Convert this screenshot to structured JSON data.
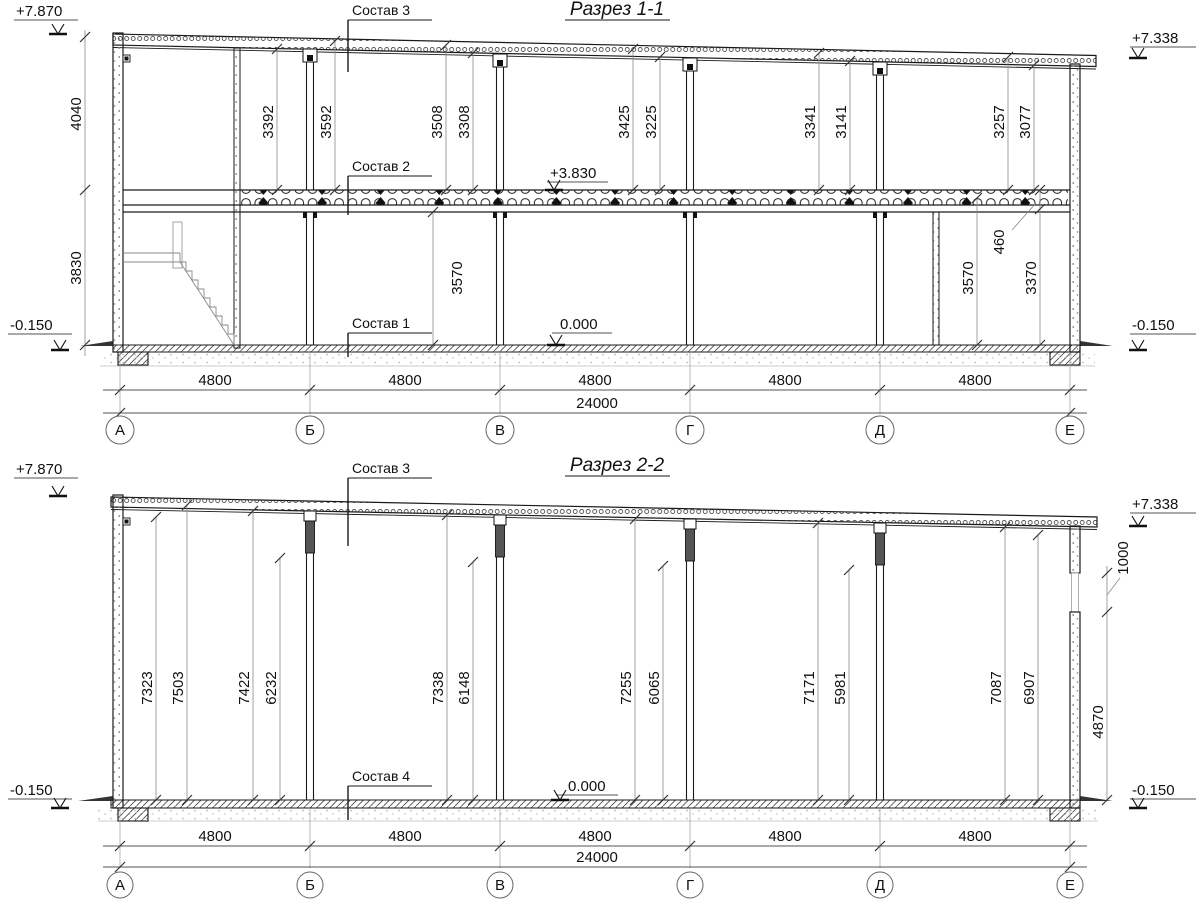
{
  "s1": {
    "title": "Разрез 1-1",
    "callouts": {
      "sostav3": "Состав 3",
      "sostav2": "Состав 2",
      "sostav1": "Состав 1"
    },
    "elevations": {
      "top_left": "+7.870",
      "top_right": "+7.338",
      "floor2": "+3.830",
      "zero": "0.000",
      "ground_left": "-0.150",
      "ground_right": "-0.150"
    },
    "left_chain": {
      "upper": "4040",
      "lower": "3830"
    },
    "upper_dims": [
      "3392",
      "3592",
      "3508",
      "3308",
      "3425",
      "3225",
      "3341",
      "3141",
      "3257",
      "3077"
    ],
    "lower_dims": {
      "mid": "3570",
      "right": "3570",
      "beam": "460",
      "right2": "3370"
    },
    "bay_dims": [
      "4800",
      "4800",
      "4800",
      "4800",
      "4800"
    ],
    "total_dim": "24000",
    "axes": [
      "А",
      "Б",
      "В",
      "Г",
      "Д",
      "Е"
    ]
  },
  "s2": {
    "title": "Разрез 2-2",
    "callouts": {
      "sostav3": "Состав 3",
      "sostav4": "Состав 4"
    },
    "elevations": {
      "top_left": "+7.870",
      "top_right": "+7.338",
      "zero": "0.000",
      "ground_left": "-0.150",
      "ground_right": "-0.150"
    },
    "height_dims": [
      "7323",
      "7503",
      "7422",
      "6232",
      "7338",
      "6148",
      "7255",
      "6065",
      "7171",
      "5981",
      "7087",
      "6907"
    ],
    "right_dims": {
      "window": "1000",
      "wall_below": "4870"
    },
    "bay_dims": [
      "4800",
      "4800",
      "4800",
      "4800",
      "4800"
    ],
    "total_dim": "24000",
    "axes": [
      "А",
      "Б",
      "В",
      "Г",
      "Д",
      "Е"
    ]
  },
  "colors": {
    "line": "#1a1a1a",
    "dim_line": "#8a8a8a",
    "fill_dark": "#555555",
    "paper": "#ffffff"
  }
}
